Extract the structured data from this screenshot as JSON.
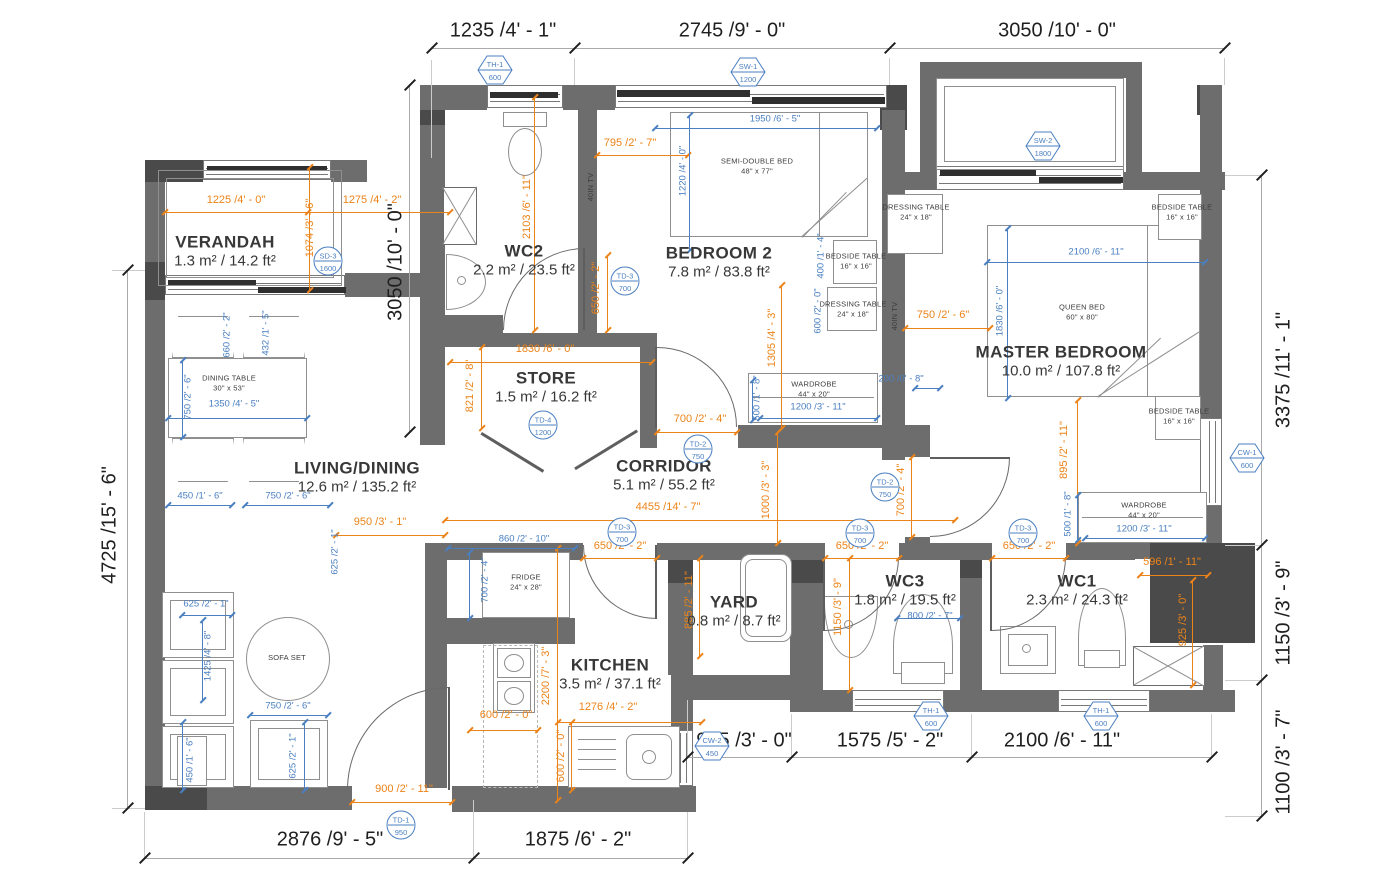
{
  "drawing": {
    "colors": {
      "wall": "#6d6d6d",
      "wall_dark": "#4a4a4a",
      "dim_orange": "#ec8318",
      "dim_blue": "#4a7fc0",
      "text": "#383838"
    },
    "rooms": [
      {
        "name": "VERANDAH",
        "area": "1.3 m² / 14.2 ft²",
        "x": 225,
        "y": 241
      },
      {
        "name": "WC2",
        "area": "2.2 m² / 23.5 ft²",
        "x": 524,
        "y": 250
      },
      {
        "name": "BEDROOM 2",
        "area": "7.8 m² / 83.8 ft²",
        "x": 719,
        "y": 252
      },
      {
        "name": "MASTER BEDROOM",
        "area": "10.0 m² / 107.8 ft²",
        "x": 1061,
        "y": 351
      },
      {
        "name": "STORE",
        "area": "1.5 m² / 16.2 ft²",
        "x": 546,
        "y": 377
      },
      {
        "name": "CORRIDOR",
        "area": "5.1 m² / 55.2 ft²",
        "x": 664,
        "y": 465
      },
      {
        "name": "LIVING/DINING",
        "area": "12.6 m² / 135.2 ft²",
        "x": 357,
        "y": 467
      },
      {
        "name": "KITCHEN",
        "area": "3.5 m² / 37.1 ft²",
        "x": 610,
        "y": 664
      },
      {
        "name": "YARD",
        "area": "0.8 m² / 8.7 ft²",
        "x": 734,
        "y": 601
      },
      {
        "name": "WC3",
        "area": "1.8 m² / 19.5 ft²",
        "x": 905,
        "y": 580
      },
      {
        "name": "WC1",
        "area": "2.3 m² / 24.3 ft²",
        "x": 1077,
        "y": 580
      }
    ],
    "dims_black": [
      {
        "t": "1235 /4' - 1\"",
        "x": 503,
        "y": 31
      },
      {
        "t": "2745 /9' - 0\"",
        "x": 732,
        "y": 31
      },
      {
        "t": "3050 /10' - 0\"",
        "x": 1057,
        "y": 31
      },
      {
        "t": "4725 /15' - 6\"",
        "x": 110,
        "y": 525,
        "r": -90
      },
      {
        "t": "3050 /10' - 0\"",
        "x": 396,
        "y": 262,
        "r": -90
      },
      {
        "t": "3375 /11' - 1\"",
        "x": 1284,
        "y": 370,
        "r": -90
      },
      {
        "t": "1150 /3' - 9\"",
        "x": 1284,
        "y": 613,
        "r": -90
      },
      {
        "t": "1100 /3' - 7\"",
        "x": 1284,
        "y": 762,
        "r": -90
      },
      {
        "t": "2876 /9' - 5\"",
        "x": 330,
        "y": 840
      },
      {
        "t": "1875 /6' - 2\"",
        "x": 578,
        "y": 840
      },
      {
        "t": "905 /3' - 0\"",
        "x": 744,
        "y": 741
      },
      {
        "t": "1575 /5' - 2\"",
        "x": 890,
        "y": 741
      },
      {
        "t": "2100 /6' - 11\"",
        "x": 1062,
        "y": 741
      }
    ],
    "dims_orange": [
      {
        "t": "1225 /4' - 0\"",
        "x": 236,
        "y": 200
      },
      {
        "t": "1074 /3' - 6\"",
        "x": 310,
        "y": 228,
        "r": -90
      },
      {
        "t": "1275 /4' - 2\"",
        "x": 372,
        "y": 200
      },
      {
        "t": "2103 /6' - 11\"",
        "x": 527,
        "y": 207,
        "r": -90
      },
      {
        "t": "795 /2' - 7\"",
        "x": 630,
        "y": 143
      },
      {
        "t": "650 /2' - 2\"",
        "x": 596,
        "y": 288,
        "r": -90
      },
      {
        "t": "1305 /4' - 3\"",
        "x": 772,
        "y": 338,
        "r": -90
      },
      {
        "t": "750 /2' - 6\"",
        "x": 943,
        "y": 315
      },
      {
        "t": "895 /2' - 11\"",
        "x": 1064,
        "y": 450,
        "r": -90
      },
      {
        "t": "1830 /6' - 0\"",
        "x": 545,
        "y": 349
      },
      {
        "t": "821 /2' - 8\"",
        "x": 470,
        "y": 386,
        "r": -90
      },
      {
        "t": "700 /2' - 4\"",
        "x": 700,
        "y": 419
      },
      {
        "t": "4455 /14' - 7\"",
        "x": 668,
        "y": 507
      },
      {
        "t": "1000 /3' - 3\"",
        "x": 766,
        "y": 490,
        "r": -90
      },
      {
        "t": "700 /2' - 4\"",
        "x": 901,
        "y": 490,
        "r": -90
      },
      {
        "t": "950 /3' - 1\"",
        "x": 380,
        "y": 522
      },
      {
        "t": "900 /2' - 11\"",
        "x": 404,
        "y": 789
      },
      {
        "t": "650 /2' - 2\"",
        "x": 620,
        "y": 546
      },
      {
        "t": "650 /2' - 2\"",
        "x": 862,
        "y": 546
      },
      {
        "t": "650 /2' - 2\"",
        "x": 1029,
        "y": 546
      },
      {
        "t": "2200 /7' - 3\"",
        "x": 546,
        "y": 676,
        "r": -90
      },
      {
        "t": "1276 /4' - 2\"",
        "x": 608,
        "y": 707
      },
      {
        "t": "600 /2' - 0\"",
        "x": 506,
        "y": 715
      },
      {
        "t": "600 /2' - 0\"",
        "x": 561,
        "y": 756,
        "r": -90
      },
      {
        "t": "885 /2' - 11\"",
        "x": 689,
        "y": 600,
        "r": -90
      },
      {
        "t": "1150 /3' - 9\"",
        "x": 838,
        "y": 607,
        "r": -90
      },
      {
        "t": "596 /1' - 11\"",
        "x": 1172,
        "y": 562
      },
      {
        "t": "925 /3' - 0\"",
        "x": 1183,
        "y": 620,
        "r": -90
      }
    ],
    "dims_blue": [
      {
        "t": "1950 /6' - 5\"",
        "x": 775,
        "y": 119
      },
      {
        "t": "1220 /4' - 0\"",
        "x": 683,
        "y": 171,
        "r": -90
      },
      {
        "t": "400 /1' - 4\"",
        "x": 821,
        "y": 256,
        "r": -90
      },
      {
        "t": "600 /2' - 0\"",
        "x": 818,
        "y": 311,
        "r": -90
      },
      {
        "t": "2100 /6' - 11\"",
        "x": 1096,
        "y": 252
      },
      {
        "t": "1830 /6' - 0\"",
        "x": 1000,
        "y": 311,
        "r": -90
      },
      {
        "t": "500 /1' - 8\"",
        "x": 757,
        "y": 398,
        "r": -90
      },
      {
        "t": "1200 /3' - 11\"",
        "x": 818,
        "y": 407
      },
      {
        "t": "200 /0' - 8\"",
        "x": 901,
        "y": 379
      },
      {
        "t": "500 /1' - 8\"",
        "x": 1068,
        "y": 514,
        "r": -90
      },
      {
        "t": "1200 /3' - 11\"",
        "x": 1144,
        "y": 529
      },
      {
        "t": "800 /2' - 7\"",
        "x": 930,
        "y": 616
      },
      {
        "t": "750 /2' - 6\"",
        "x": 188,
        "y": 397,
        "r": -90
      },
      {
        "t": "1350 /4' - 5\"",
        "x": 234,
        "y": 404
      },
      {
        "t": "660 /2' - 2\"",
        "x": 227,
        "y": 335,
        "r": -90
      },
      {
        "t": "432 /1' - 5\"",
        "x": 266,
        "y": 333,
        "r": -90
      },
      {
        "t": "450 /1' - 6\"",
        "x": 200,
        "y": 496
      },
      {
        "t": "750 /2' - 6\"",
        "x": 288,
        "y": 496
      },
      {
        "t": "625 /2' - 1\"",
        "x": 335,
        "y": 552,
        "r": -90
      },
      {
        "t": "625 /2' - 1\"",
        "x": 206,
        "y": 604
      },
      {
        "t": "1425 /4' - 8\"",
        "x": 208,
        "y": 656,
        "r": -90
      },
      {
        "t": "750 /2' - 6\"",
        "x": 288,
        "y": 706
      },
      {
        "t": "625 /2' - 1\"",
        "x": 293,
        "y": 756,
        "r": -90
      },
      {
        "t": "450 /1' - 6\"",
        "x": 190,
        "y": 760,
        "r": -90
      },
      {
        "t": "860 /2' - 10\"",
        "x": 524,
        "y": 539
      },
      {
        "t": "700 /2' - 4\"",
        "x": 485,
        "y": 580,
        "r": -90
      }
    ],
    "furniture_labels": [
      {
        "lines": [
          "DINING TABLE",
          "30\" x 53\""
        ],
        "x": 229,
        "y": 383
      },
      {
        "lines": [
          "SOFA SET"
        ],
        "x": 287,
        "y": 658
      },
      {
        "lines": [
          "FRIDGE",
          "24\" x 28\""
        ],
        "x": 526,
        "y": 582
      },
      {
        "lines": [
          "SEMI-DOUBLE BED",
          "48\" x 77\""
        ],
        "x": 757,
        "y": 166
      },
      {
        "lines": [
          "QUEEN BED",
          "60\" x 80\""
        ],
        "x": 1082,
        "y": 312
      },
      {
        "lines": [
          "BEDSIDE TABLE",
          "16\" x 16\""
        ],
        "x": 856,
        "y": 261
      },
      {
        "lines": [
          "DRESSING TABLE",
          "24\" x 18\""
        ],
        "x": 853,
        "y": 309
      },
      {
        "lines": [
          "DRESSING TABLE",
          "24\" x 18\""
        ],
        "x": 916,
        "y": 212
      },
      {
        "lines": [
          "BEDSIDE TABLE",
          "16\" x 16\""
        ],
        "x": 1182,
        "y": 212
      },
      {
        "lines": [
          "BEDSIDE TABLE",
          "16\" x 16\""
        ],
        "x": 1179,
        "y": 416
      },
      {
        "lines": [
          "WARDROBE",
          "44\" x 20\""
        ],
        "x": 814,
        "y": 389
      },
      {
        "lines": [
          "WARDROBE",
          "44\" x 20\""
        ],
        "x": 1144,
        "y": 510
      },
      {
        "lines": [
          "40IN TV"
        ],
        "x": 591,
        "y": 187,
        "r": -90
      },
      {
        "lines": [
          "40IN TV"
        ],
        "x": 895,
        "y": 316,
        "r": -90
      }
    ],
    "markers_hex": [
      {
        "c": "TH-1",
        "s": "600",
        "x": 495,
        "y": 70
      },
      {
        "c": "SW-1",
        "s": "1200",
        "x": 748,
        "y": 72
      },
      {
        "c": "SW-2",
        "s": "1800",
        "x": 1043,
        "y": 146
      },
      {
        "c": "CW-1",
        "s": "600",
        "x": 1247,
        "y": 458
      },
      {
        "c": "CW-2",
        "s": "450",
        "x": 712,
        "y": 746
      },
      {
        "c": "TH-1",
        "s": "600",
        "x": 931,
        "y": 716
      },
      {
        "c": "TH-1",
        "s": "600",
        "x": 1101,
        "y": 716
      }
    ],
    "markers_circle": [
      {
        "c": "SD-3",
        "s": "1600",
        "x": 328,
        "y": 261
      },
      {
        "c": "TD-3",
        "s": "700",
        "x": 625,
        "y": 281
      },
      {
        "c": "TD-4",
        "s": "1200",
        "x": 543,
        "y": 425
      },
      {
        "c": "TD-2",
        "s": "750",
        "x": 698,
        "y": 449
      },
      {
        "c": "TD-2",
        "s": "750",
        "x": 885,
        "y": 487
      },
      {
        "c": "TD-3",
        "s": "700",
        "x": 622,
        "y": 532
      },
      {
        "c": "TD-3",
        "s": "700",
        "x": 860,
        "y": 533
      },
      {
        "c": "TD-3",
        "s": "700",
        "x": 1023,
        "y": 533
      },
      {
        "c": "TD-1",
        "s": "950",
        "x": 401,
        "y": 825
      }
    ]
  }
}
